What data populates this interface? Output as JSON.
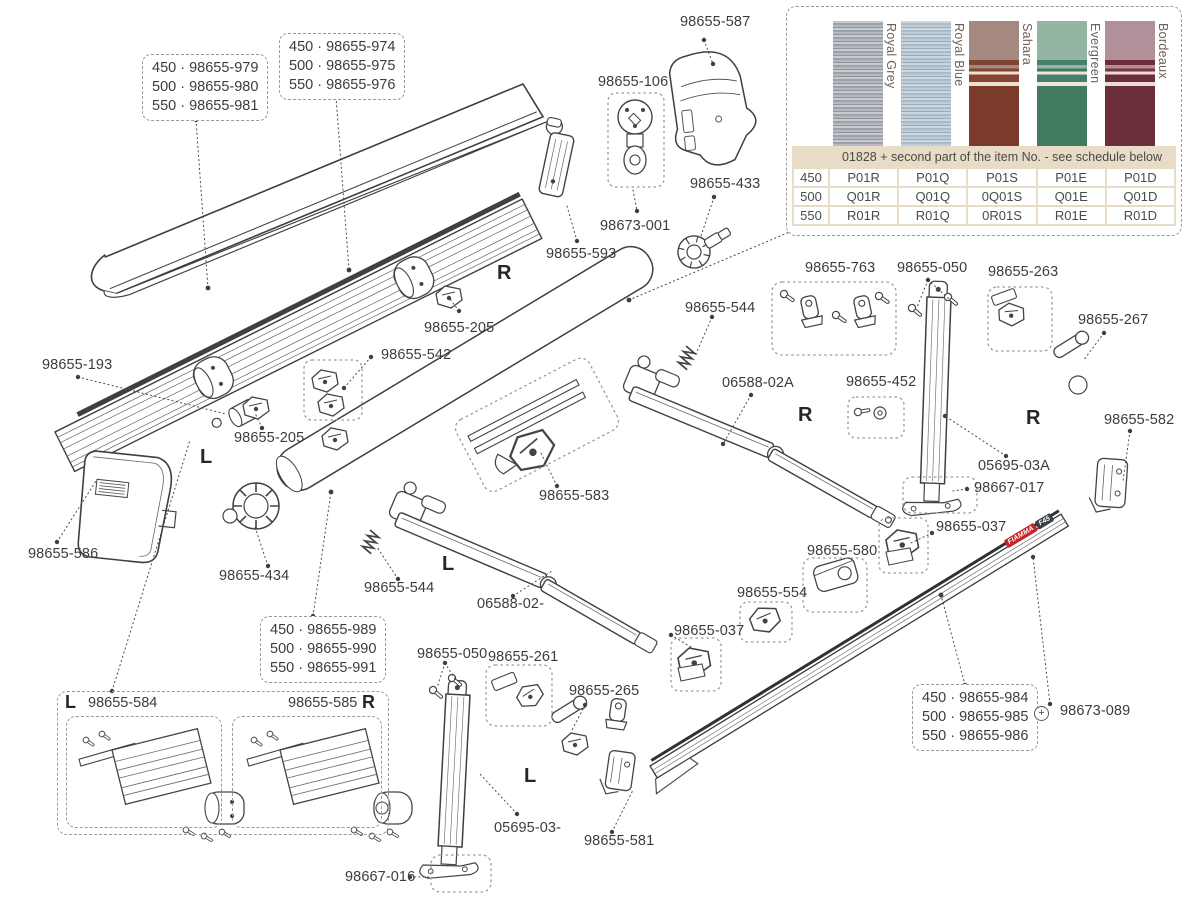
{
  "product_logo": {
    "brand": "FIAMMA",
    "model": "F45"
  },
  "markers": {
    "left": "L",
    "right": "R"
  },
  "labels": {
    "p587": "98655-587",
    "p106": "98655-106",
    "p673001": "98673-001",
    "p433": "98655-433",
    "p593": "98655-593",
    "p205a": "98655-205",
    "p205b": "98655-205",
    "p542": "98655-542",
    "p193": "98655-193",
    "p586": "98655-586",
    "p434": "98655-434",
    "p583": "98655-583",
    "p544a": "98655-544",
    "p544b": "98655-544",
    "p06588A": "06588-02A",
    "p06588": "06588-02-",
    "p763": "98655-763",
    "p452": "98655-452",
    "p050a": "98655-050",
    "p050b": "98655-050",
    "p263": "98655-263",
    "p267": "98655-267",
    "p05695A": "05695-03A",
    "p667017": "98667-017",
    "p582": "98655-582",
    "p037a": "98655-037",
    "p037b": "98655-037",
    "p580": "98655-580",
    "p554": "98655-554",
    "p261": "98655-261",
    "p265": "98655-265",
    "p05695": "05695-03-",
    "p581": "98655-581",
    "p667016": "98667-016",
    "p673089": "98673-089",
    "p584": "98655-584",
    "p585": "98655-585"
  },
  "size_boxes": {
    "lid": [
      "450 · 98655-979",
      "500 · 98655-980",
      "550 · 98655-981"
    ],
    "case": [
      "450 · 98655-974",
      "500 · 98655-975",
      "550 · 98655-976"
    ],
    "roller": [
      "450 · 98655-989",
      "500 · 98655-990",
      "550 · 98655-991"
    ],
    "leadbar": [
      "450 · 98655-984",
      "500 · 98655-985",
      "550 · 98655-986"
    ]
  },
  "join_symbol": "+",
  "fabric_panel": {
    "table_header": "01828 + second part of the item No. - see schedule below",
    "swatches": [
      {
        "name": "Royal Grey",
        "color": "#a7adb3"
      },
      {
        "name": "Royal Blue",
        "color": "#b0bfcc"
      },
      {
        "name": "Sahara",
        "color": "#7b3a2a"
      },
      {
        "name": "Evergreen",
        "color": "#417a5e"
      },
      {
        "name": "Bordeaux",
        "color": "#6d2e3b"
      }
    ],
    "rows": [
      {
        "size": "450",
        "codes": [
          "P01R",
          "P01Q",
          "P01S",
          "P01E",
          "P01D"
        ]
      },
      {
        "size": "500",
        "codes": [
          "Q01R",
          "Q01Q",
          "0Q01S",
          "Q01E",
          "Q01D"
        ]
      },
      {
        "size": "550",
        "codes": [
          "R01R",
          "R01Q",
          "0R01S",
          "R01E",
          "R01D"
        ]
      }
    ]
  }
}
